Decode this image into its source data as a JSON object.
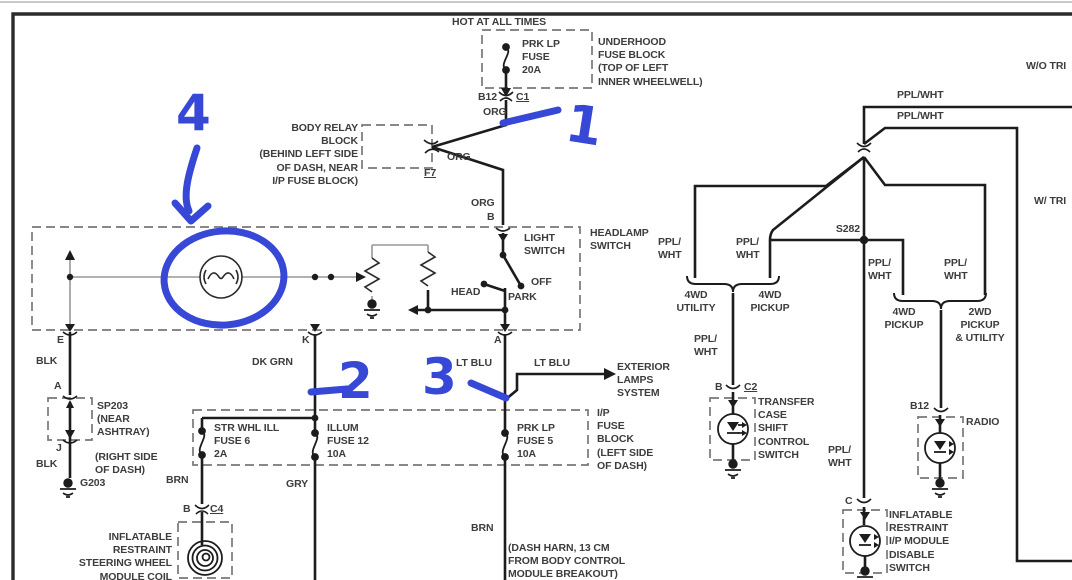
{
  "colors": {
    "annotation_blue": "#3747d6",
    "wire_black": "#1c1c1c",
    "wire_gray": "#979797",
    "dash_gray": "#787878",
    "text_gray": "#3d3d3d"
  },
  "top": {
    "hot": "HOT AT ALL TIMES",
    "fuse": "PRK LP\nFUSE\n20A",
    "underhood": "UNDERHOOD\nFUSE BLOCK\n(TOP OF LEFT\nINNER WHEELWELL)",
    "b12": "B12",
    "c1": "C1",
    "org": "ORG"
  },
  "body_relay": {
    "label": "BODY RELAY\nBLOCK\n(BEHIND LEFT SIDE\nOF DASH, NEAR\nI/P FUSE BLOCK)",
    "f7": "F7",
    "b": "B"
  },
  "headlamp": {
    "title": "HEADLAMP\nSWITCH",
    "light_switch": "LIGHT\nSWITCH",
    "off": "OFF",
    "head": "HEAD",
    "park": "PARK",
    "e": "E",
    "k": "K",
    "a": "A"
  },
  "ground_branch": {
    "blk": "BLK",
    "a": "A",
    "j": "J",
    "sp203": "SP203\n(NEAR\nASHTRAY)",
    "right_side": "(RIGHT SIDE\nOF DASH)",
    "g203": "G203"
  },
  "wires": {
    "dk_grn": "DK GRN",
    "lt_blu": "LT BLU",
    "brn": "BRN",
    "gry": "GRY",
    "ppl_wht": "PPL/WHT",
    "ppl_wht_stacked": "PPL/\nWHT"
  },
  "exterior": {
    "label": "EXTERIOR\nLAMPS\nSYSTEM"
  },
  "ip_block": {
    "label": "I/P\nFUSE\nBLOCK\n(LEFT SIDE\nOF DASH)",
    "fuse6": "STR WHL ILL\nFUSE 6\n2A",
    "fuse12": "ILLUM\nFUSE 12\n10A",
    "fuse5": "PRK LP\nFUSE 5\n10A"
  },
  "sir_coil": {
    "b": "B",
    "c4": "C4",
    "label": "INFLATABLE\nRESTRAINT\nSTEERING WHEEL\nMODULE COIL"
  },
  "dash_harn": {
    "label": "(DASH HARN, 13 CM\nFROM BODY CONTROL\nMODULE BREAKOUT)"
  },
  "right": {
    "wo_tri": "W/O TRI",
    "w_tri": "W/ TRI",
    "s282": "S282",
    "util_4wd": "4WD\nUTILITY",
    "pickup_4wd": "4WD\nPICKUP",
    "pickup_2wd": "2WD\nPICKUP\n& UTILITY",
    "transfer": "TRANSFER\nCASE\nSHIFT\nCONTROL\nSWITCH",
    "radio": "RADIO",
    "disable": "INFLATABLE\nRESTRAINT\nI/P MODULE\nDISABLE\nSWITCH",
    "b": "B",
    "c2": "C2",
    "b12": "B12",
    "c": "C"
  },
  "annotations": {
    "one": "1",
    "two": "2",
    "three": "3",
    "four": "4"
  }
}
